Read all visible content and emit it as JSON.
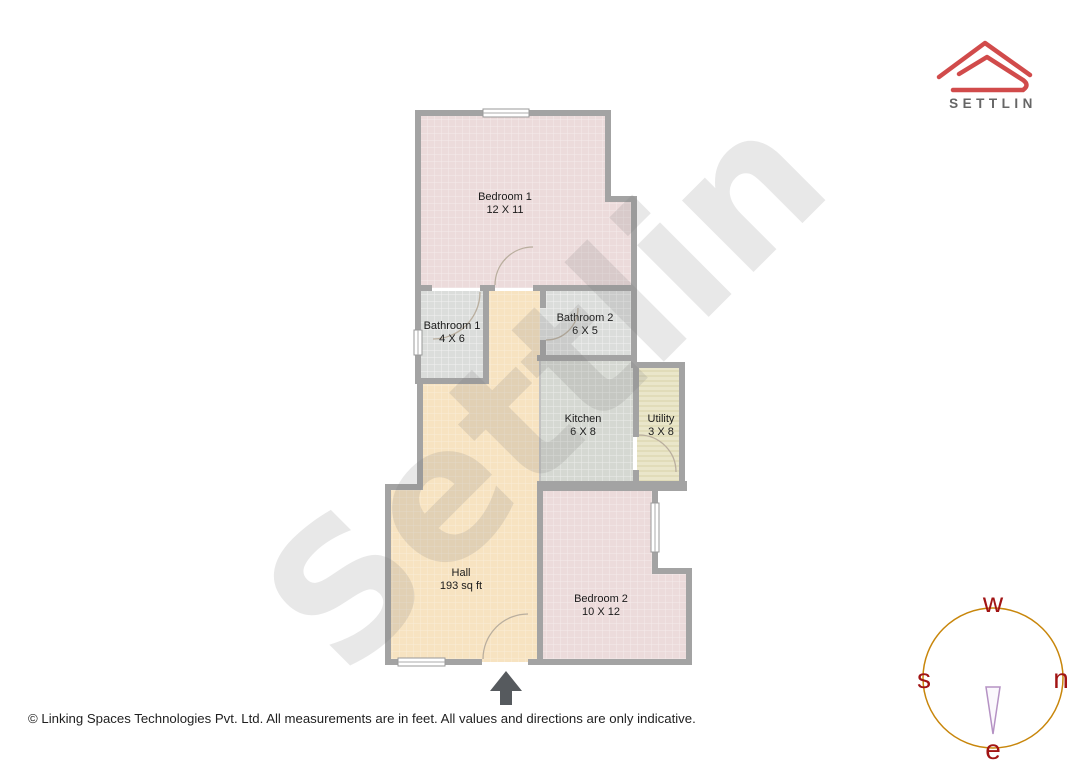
{
  "brand": {
    "wordmark": "SETTLIN"
  },
  "watermark_text": "Settlin",
  "plan": {
    "rooms": [
      {
        "name": "Bedroom 1",
        "dims": "12 X 11"
      },
      {
        "name": "Bathroom 1",
        "dims": "4 X 6"
      },
      {
        "name": "Bathroom 2",
        "dims": "6 X 5"
      },
      {
        "name": "Kitchen",
        "dims": "6 X 8"
      },
      {
        "name": "Utility",
        "dims": "3 X 8"
      },
      {
        "name": "Hall",
        "dims": "193 sq ft"
      },
      {
        "name": "Bedroom 2",
        "dims": "10 X 12"
      }
    ]
  },
  "compass": {
    "top": "w",
    "left": "s",
    "right": "n",
    "bottom": "e"
  },
  "footer": {
    "copyright": "© Linking Spaces Technologies Pvt. Ltd. All measurements are in feet. All values and directions are only indicative."
  },
  "colors": {
    "brand_red": "#d14b4b",
    "wall_gray": "#a3a3a3",
    "compass_ring": "#c8860b",
    "compass_letters": "#a11414",
    "bedroom_floor": "#ecdbdb",
    "bath_floor": "#dbdddb",
    "kitchen_floor": "#d5d8d2",
    "hall_floor": "#f7e3c1",
    "utility_floor": "#eae6ca"
  }
}
